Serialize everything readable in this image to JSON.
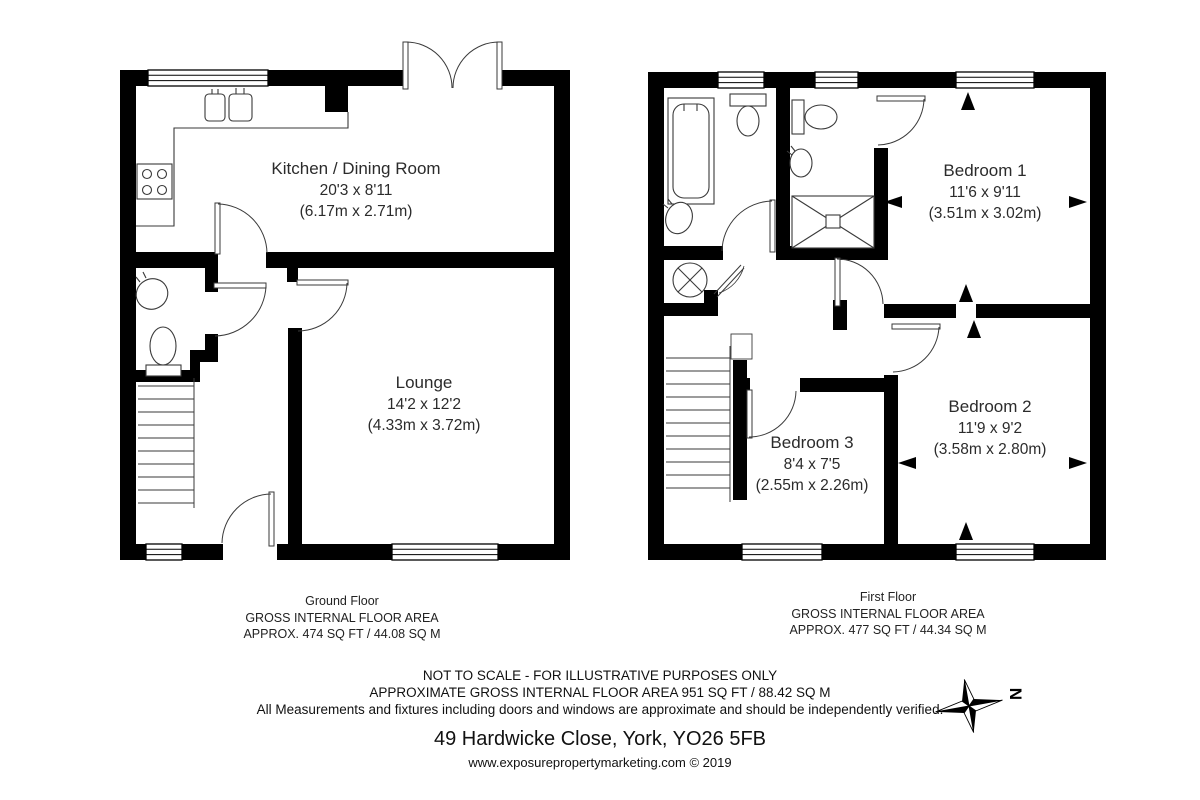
{
  "ground_floor": {
    "rooms": [
      {
        "name": "Kitchen / Dining Room",
        "imperial": "20'3 x 8'11",
        "metric": "(6.17m x 2.71m)"
      },
      {
        "name": "Lounge",
        "imperial": "14'2 x 12'2",
        "metric": "(4.33m x 3.72m)"
      }
    ],
    "caption": {
      "title": "Ground Floor",
      "line1": "GROSS INTERNAL FLOOR AREA",
      "line2": "APPROX. 474 SQ FT / 44.08 SQ M"
    }
  },
  "first_floor": {
    "rooms": [
      {
        "name": "Bedroom 1",
        "imperial": "11'6 x 9'11",
        "metric": "(3.51m x 3.02m)"
      },
      {
        "name": "Bedroom 2",
        "imperial": "11'9 x 9'2",
        "metric": "(3.58m x 2.80m)"
      },
      {
        "name": "Bedroom 3",
        "imperial": "8'4 x 7'5",
        "metric": "(2.55m x 2.26m)"
      }
    ],
    "caption": {
      "title": "First Floor",
      "line1": "GROSS INTERNAL FLOOR AREA",
      "line2": "APPROX. 477 SQ FT / 44.34 SQ M"
    }
  },
  "footer": {
    "disclaimer1": "NOT TO SCALE - FOR ILLUSTRATIVE PURPOSES ONLY",
    "disclaimer2": "APPROXIMATE GROSS INTERNAL FLOOR AREA 951 SQ FT / 88.42 SQ M",
    "disclaimer3": "All Measurements and fixtures including doors and windows are approximate and should be independently verified.",
    "address": "49 Hardwicke Close, York, YO26 5FB",
    "website": "www.exposurepropertymarketing.com © 2019"
  },
  "compass": {
    "label": "N"
  },
  "colors": {
    "wall": "#000000",
    "text": "#2b2b2b",
    "fixture_line": "#3a3a3a"
  }
}
